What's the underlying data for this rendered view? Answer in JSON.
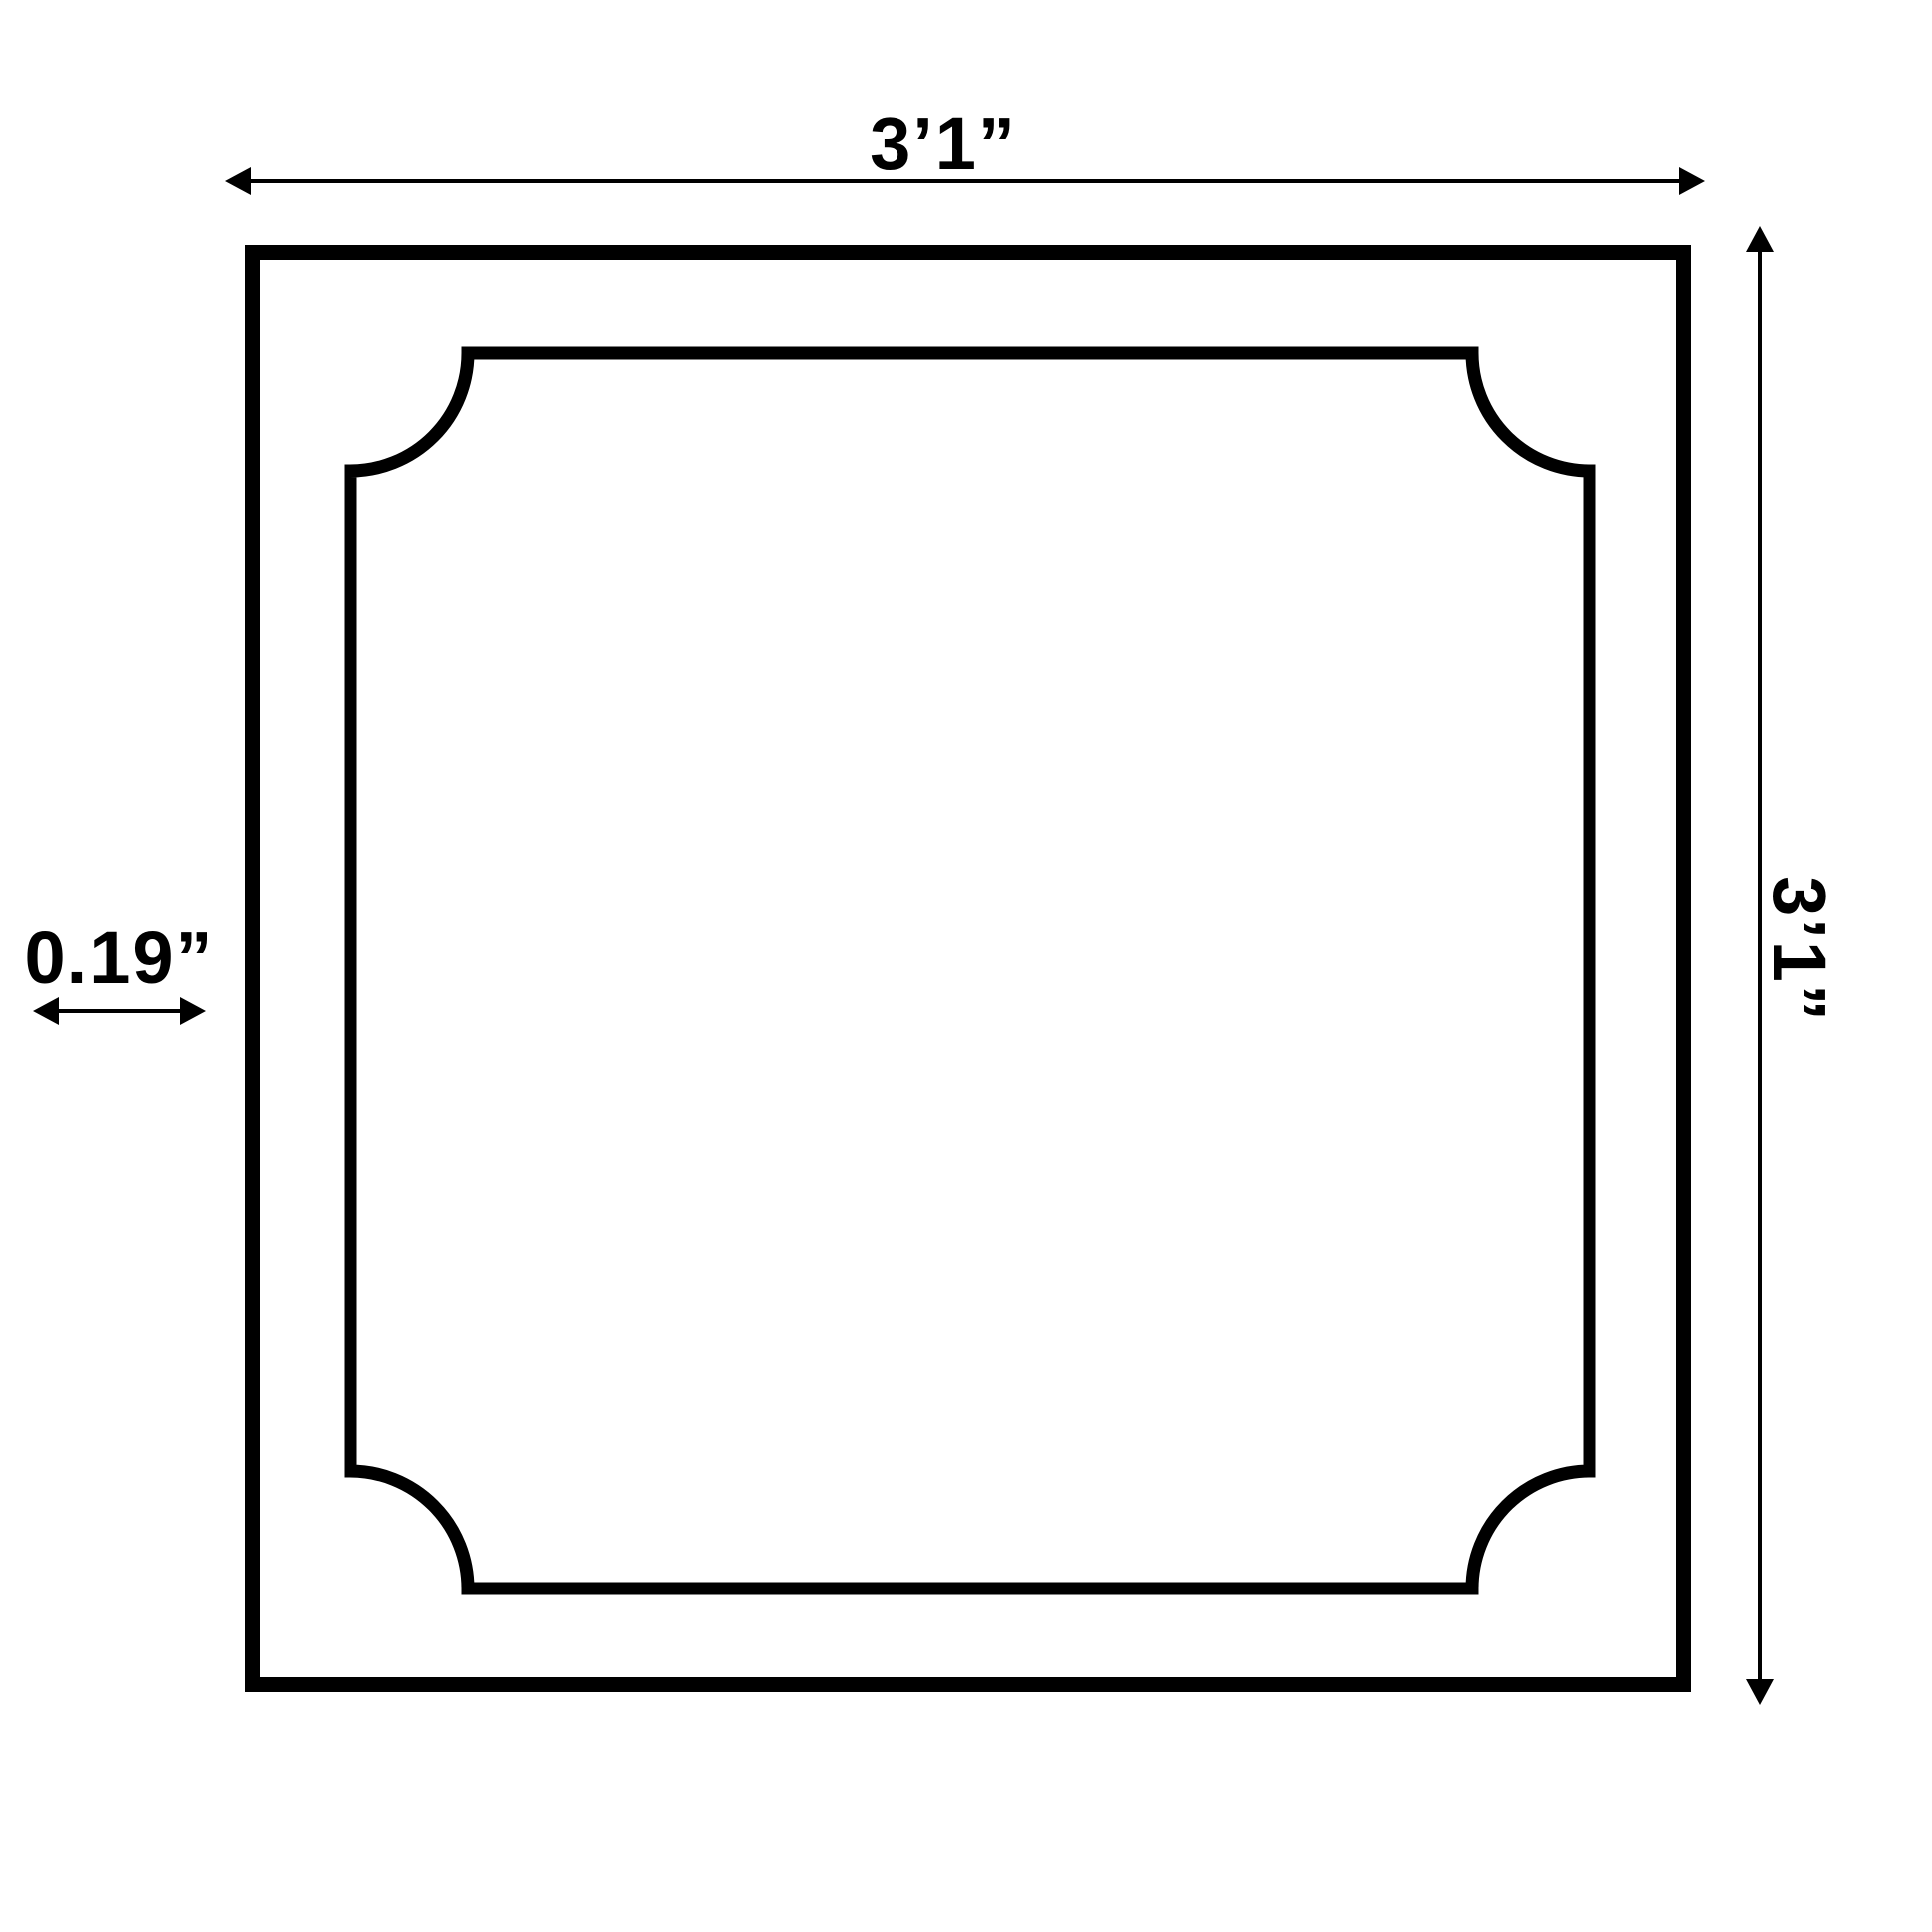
{
  "diagram": {
    "name": "square-panel-dimension-drawing",
    "shape": {
      "outer": "square",
      "inner": "square outline with concave quarter-circle scooped corners"
    },
    "dimensions": {
      "width": {
        "label": "3’1”",
        "position": "top"
      },
      "height": {
        "label": "3’1”",
        "position": "right"
      },
      "thickness": {
        "label": "0.19”",
        "position": "left"
      }
    }
  },
  "colors": {
    "ink": "#000000",
    "background": "#ffffff"
  }
}
